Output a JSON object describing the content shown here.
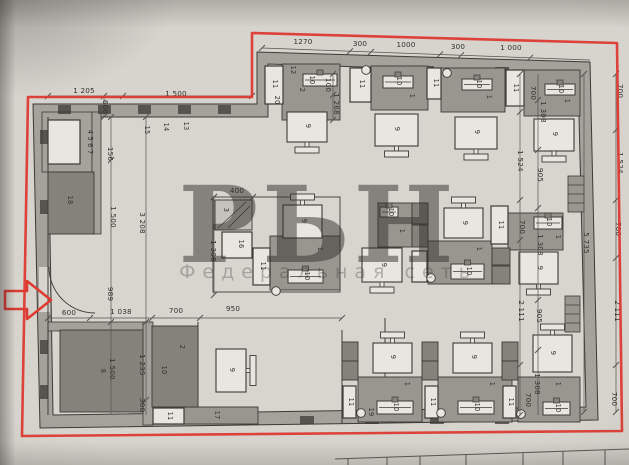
{
  "watermark": {
    "letters": "РЬН",
    "tagline": "Федеральная сеть"
  },
  "plan": {
    "colors": {
      "red": "#dd3a32",
      "pink": "#db8097",
      "paper": "#d7d4ce",
      "floor": "#d8d5cf",
      "wall": "#a4a29b",
      "gray": "#98968f",
      "dark": "#84827b",
      "darker": "#7b7a74",
      "white": "#e8e6e0",
      "ink": "#3b3a34"
    },
    "dimensions": [
      {
        "text": "1 205",
        "x": 84,
        "y": 93,
        "r": 0
      },
      {
        "text": "1 500",
        "x": 176,
        "y": 96,
        "r": 0
      },
      {
        "text": "600",
        "x": 103,
        "y": 107,
        "r": 90
      },
      {
        "text": "1270",
        "x": 303,
        "y": 44,
        "r": 0
      },
      {
        "text": "300",
        "x": 360,
        "y": 46,
        "r": 0
      },
      {
        "text": "1000",
        "x": 406,
        "y": 47,
        "r": 0
      },
      {
        "text": "300",
        "x": 458,
        "y": 49,
        "r": 0
      },
      {
        "text": "1 000",
        "x": 511,
        "y": 50,
        "r": 0
      },
      {
        "text": "100",
        "x": 326,
        "y": 85,
        "r": 90
      },
      {
        "text": "1 268",
        "x": 334,
        "y": 104,
        "r": 90
      },
      {
        "text": "700",
        "x": 531,
        "y": 93,
        "r": 90
      },
      {
        "text": "1 308",
        "x": 541,
        "y": 112,
        "r": 90
      },
      {
        "text": "700",
        "x": 618,
        "y": 91,
        "r": 90
      },
      {
        "text": "156",
        "x": 108,
        "y": 154,
        "r": 90
      },
      {
        "text": "1 524",
        "x": 518,
        "y": 161,
        "r": 90
      },
      {
        "text": "905",
        "x": 538,
        "y": 175,
        "r": 90
      },
      {
        "text": "1 524",
        "x": 618,
        "y": 163,
        "r": 90
      },
      {
        "text": "1 500",
        "x": 111,
        "y": 217,
        "r": 90
      },
      {
        "text": "3 208",
        "x": 140,
        "y": 223,
        "r": 90
      },
      {
        "text": "1 308",
        "x": 211,
        "y": 251,
        "r": 90
      },
      {
        "text": "400",
        "x": 237,
        "y": 193,
        "r": 0
      },
      {
        "text": "700",
        "x": 520,
        "y": 227,
        "r": 90
      },
      {
        "text": "1 308",
        "x": 538,
        "y": 245,
        "r": 90
      },
      {
        "text": "5 735",
        "x": 584,
        "y": 243,
        "r": 90
      },
      {
        "text": "700",
        "x": 616,
        "y": 229,
        "r": 90
      },
      {
        "text": "989",
        "x": 108,
        "y": 294,
        "r": 90
      },
      {
        "text": "600",
        "x": 69,
        "y": 315,
        "r": 0
      },
      {
        "text": "1 038",
        "x": 121,
        "y": 314,
        "r": 0
      },
      {
        "text": "700",
        "x": 176,
        "y": 313,
        "r": 0
      },
      {
        "text": "950",
        "x": 233,
        "y": 311,
        "r": 0
      },
      {
        "text": "2 111",
        "x": 519,
        "y": 311,
        "r": 90
      },
      {
        "text": "905",
        "x": 537,
        "y": 316,
        "r": 90
      },
      {
        "text": "2 111",
        "x": 615,
        "y": 311,
        "r": 90
      },
      {
        "text": "1 500",
        "x": 110,
        "y": 369,
        "r": 90
      },
      {
        "text": "1 235",
        "x": 140,
        "y": 365,
        "r": 90
      },
      {
        "text": "1 308",
        "x": 535,
        "y": 384,
        "r": 90
      },
      {
        "text": "700",
        "x": 526,
        "y": 400,
        "r": 90
      },
      {
        "text": "700",
        "x": 612,
        "y": 399,
        "r": 90
      },
      {
        "text": "300",
        "x": 140,
        "y": 405,
        "r": 90
      }
    ],
    "labels": [
      {
        "text": "4 5 6 7",
        "x": 88,
        "y": 142,
        "r": 90
      },
      {
        "text": "18",
        "x": 68,
        "y": 200,
        "r": 90
      },
      {
        "text": "15",
        "x": 145,
        "y": 130,
        "r": 90
      },
      {
        "text": "14",
        "x": 164,
        "y": 127,
        "r": 90
      },
      {
        "text": "13",
        "x": 184,
        "y": 126,
        "r": 90
      },
      {
        "text": "11",
        "x": 273,
        "y": 84,
        "r": 90
      },
      {
        "text": "12",
        "x": 291,
        "y": 70,
        "r": 90
      },
      {
        "text": "2",
        "x": 300,
        "y": 90,
        "r": 90
      },
      {
        "text": "20",
        "x": 275,
        "y": 100,
        "r": 90
      },
      {
        "text": "10",
        "x": 310,
        "y": 80,
        "r": 90
      },
      {
        "text": "9",
        "x": 306,
        "y": 126,
        "r": 90
      },
      {
        "text": "11",
        "x": 360,
        "y": 84,
        "r": 90
      },
      {
        "text": "10",
        "x": 397,
        "y": 81,
        "r": 90
      },
      {
        "text": "1",
        "x": 410,
        "y": 96,
        "r": 90
      },
      {
        "text": "9",
        "x": 395,
        "y": 129,
        "r": 90
      },
      {
        "text": "11",
        "x": 434,
        "y": 83,
        "r": 90
      },
      {
        "text": "10",
        "x": 477,
        "y": 84,
        "r": 90
      },
      {
        "text": "1",
        "x": 487,
        "y": 97,
        "r": 90
      },
      {
        "text": "9",
        "x": 475,
        "y": 132,
        "r": 90
      },
      {
        "text": "11",
        "x": 514,
        "y": 88,
        "r": 90
      },
      {
        "text": "10",
        "x": 559,
        "y": 89,
        "r": 90
      },
      {
        "text": "1",
        "x": 565,
        "y": 101,
        "r": 90
      },
      {
        "text": "9",
        "x": 553,
        "y": 134,
        "r": 90
      },
      {
        "text": "3",
        "x": 224,
        "y": 210,
        "r": 90
      },
      {
        "text": "16",
        "x": 239,
        "y": 244,
        "r": 90
      },
      {
        "text": "11",
        "x": 261,
        "y": 266,
        "r": 90
      },
      {
        "text": "1",
        "x": 318,
        "y": 249,
        "r": 90
      },
      {
        "text": "10",
        "x": 305,
        "y": 276,
        "r": 90
      },
      {
        "text": "9",
        "x": 302,
        "y": 221,
        "r": 90
      },
      {
        "text": "9",
        "x": 382,
        "y": 265,
        "r": 90
      },
      {
        "text": "1",
        "x": 400,
        "y": 231,
        "r": 90
      },
      {
        "text": "10",
        "x": 389,
        "y": 212,
        "r": 90
      },
      {
        "text": "9",
        "x": 463,
        "y": 223,
        "r": 90
      },
      {
        "text": "11",
        "x": 499,
        "y": 225,
        "r": 90
      },
      {
        "text": "10",
        "x": 547,
        "y": 222,
        "r": 90
      },
      {
        "text": "1",
        "x": 556,
        "y": 237,
        "r": 90
      },
      {
        "text": "9",
        "x": 538,
        "y": 268,
        "r": 90
      },
      {
        "text": "1",
        "x": 477,
        "y": 249,
        "r": 90
      },
      {
        "text": "10",
        "x": 467,
        "y": 271,
        "r": 90
      },
      {
        "text": "8",
        "x": 101,
        "y": 371,
        "r": 90
      },
      {
        "text": "2",
        "x": 180,
        "y": 347,
        "r": 90
      },
      {
        "text": "10",
        "x": 162,
        "y": 370,
        "r": 90
      },
      {
        "text": "9",
        "x": 230,
        "y": 370,
        "r": 90
      },
      {
        "text": "11",
        "x": 168,
        "y": 416,
        "r": 90
      },
      {
        "text": "17",
        "x": 215,
        "y": 415,
        "r": 90
      },
      {
        "text": "11",
        "x": 349,
        "y": 402,
        "r": 90
      },
      {
        "text": "19",
        "x": 369,
        "y": 412,
        "r": 90
      },
      {
        "text": "10",
        "x": 394,
        "y": 407,
        "r": 90
      },
      {
        "text": "1",
        "x": 405,
        "y": 384,
        "r": 90
      },
      {
        "text": "9",
        "x": 391,
        "y": 357,
        "r": 90
      },
      {
        "text": "11",
        "x": 431,
        "y": 402,
        "r": 90
      },
      {
        "text": "10",
        "x": 475,
        "y": 407,
        "r": 90
      },
      {
        "text": "1",
        "x": 490,
        "y": 384,
        "r": 90
      },
      {
        "text": "9",
        "x": 472,
        "y": 357,
        "r": 90
      },
      {
        "text": "11",
        "x": 509,
        "y": 402,
        "r": 90
      },
      {
        "text": "10",
        "x": 556,
        "y": 408,
        "r": 90
      },
      {
        "text": "1",
        "x": 556,
        "y": 384,
        "r": 90
      },
      {
        "text": "9",
        "x": 551,
        "y": 353,
        "r": 90
      }
    ]
  }
}
